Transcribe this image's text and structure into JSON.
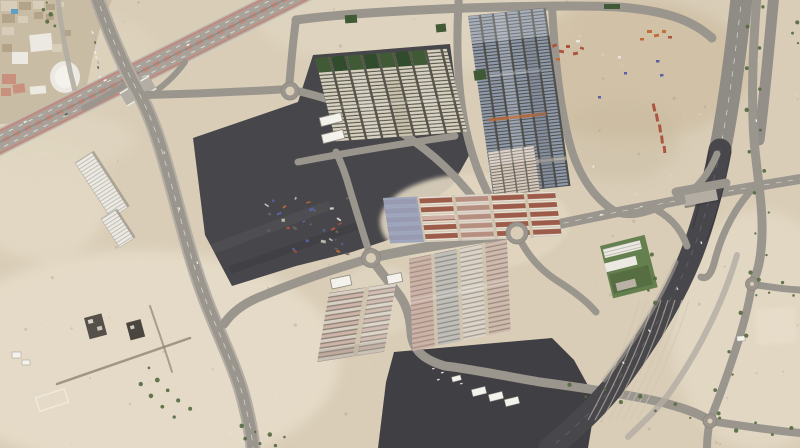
{
  "meta": {
    "type": "satellite-imagery",
    "description": "Aerial satellite view of a desert industrial district: container and trailer cabin yards, dark asphalt laydown lots, a striped divided highway with an overpass near an urban block, five roundabouts, a dark curving expressway and tree-lined service roads",
    "width": 800,
    "height": 448
  },
  "palette": {
    "sand": "#d9cdb7",
    "sand-light": "#e7ddca",
    "sand-mid": "#e0d5c0",
    "sand-dark": "#c6b69b",
    "dirt-brown": "#cdbc9f",
    "mottle-dark": "#a8937a",
    "mottle-light": "#ece4d2",
    "road": "#9a958d",
    "road-light": "#b3ada3",
    "road-dark": "#84807a",
    "lane-line": "#eeece6",
    "hw-base": "#a8a29a",
    "stripe-pink": "#c9877a",
    "median-grey": "#8b867e",
    "asphalt-lot": "#47464a",
    "asphalt-lot2": "#404044",
    "expressway-dark": "#48474b",
    "wall-dark": "#323237",
    "yard-tan": "#d7d0bf",
    "yard-tan-gap": "#56544b",
    "yard-blue": "#8f9aac",
    "yard-blue-gap": "#4e4e4a",
    "yard-red": "#9c5c49",
    "yard-white": "#e9e4da",
    "yard-lavender": "#97a1bb",
    "yard-pink": "#cdb3a8",
    "yard-pink2": "#d9cec3",
    "yard-row-gap": "#8a8275",
    "yard-mixed": "#d3c9bb",
    "aisle-sand": "#cfc4ae",
    "small-pink": "#d8c9bd",
    "small-pink-gap": "#6e6a60",
    "green-dark": "#3f5a35",
    "green-dark2": "#314c2c",
    "green-lawn": "#65804f",
    "tree-green": "#54693f",
    "tent-white": "#f4f2ec",
    "bld-white": "#ebe9e1",
    "bld-rib": "#82807a",
    "container-red": "#ad5540",
    "container-orange": "#bf6c38",
    "container-blue": "#5a62a5",
    "container-white": "#e8e4dc",
    "pool-blue": "#5f9fc4",
    "urban-base": "#c9bca4",
    "bld-tan": "#b3a489",
    "bld-tan2": "#d8cdb8",
    "bld-salmon": "#c9907e",
    "debris-light": "#e4ddcf",
    "shadow": "#6b675f"
  },
  "scene": {
    "roundabouts": [
      {
        "cx": 290,
        "cy": 91,
        "r": 9
      },
      {
        "cx": 371,
        "cy": 258,
        "r": 9.5
      },
      {
        "cx": 517,
        "cy": 233,
        "r": 11
      },
      {
        "cx": 752,
        "cy": 284,
        "r": 6.5
      },
      {
        "cx": 710,
        "cy": 421,
        "r": 7
      }
    ],
    "tents": [
      {
        "x": 320,
        "y": 115,
        "w": 22,
        "h": 9,
        "rot": -14
      },
      {
        "x": 322,
        "y": 132,
        "w": 22,
        "h": 9,
        "rot": -14
      },
      {
        "x": 331,
        "y": 277,
        "w": 20,
        "h": 10,
        "rot": -12
      },
      {
        "x": 387,
        "y": 274,
        "w": 15,
        "h": 9,
        "rot": -12
      }
    ],
    "trailers": [
      {
        "x": 472,
        "y": 388,
        "w": 14,
        "h": 7,
        "rot": -14
      },
      {
        "x": 489,
        "y": 393,
        "w": 14,
        "h": 7,
        "rot": -14
      },
      {
        "x": 505,
        "y": 398,
        "w": 14,
        "h": 7,
        "rot": -14
      },
      {
        "x": 452,
        "y": 376,
        "w": 9,
        "h": 5,
        "rot": -14
      },
      {
        "x": 737,
        "y": 336,
        "w": 8,
        "h": 5,
        "rot": -4
      },
      {
        "x": 12,
        "y": 352,
        "w": 9,
        "h": 6,
        "rot": 0
      },
      {
        "x": 22,
        "y": 360,
        "w": 8,
        "h": 5,
        "rot": 0
      }
    ],
    "green_squares": [
      {
        "x": 345,
        "y": 15,
        "w": 12,
        "h": 8,
        "rot": -4
      },
      {
        "x": 436,
        "y": 24,
        "w": 10,
        "h": 8,
        "rot": -6
      },
      {
        "x": 474,
        "y": 70,
        "w": 12,
        "h": 10,
        "rot": -8
      },
      {
        "x": 604,
        "y": 4,
        "w": 16,
        "h": 5,
        "rot": 0
      }
    ],
    "containers": [
      {
        "x": 552,
        "y": 44,
        "w": 5,
        "h": 3,
        "rot": -20,
        "c": "container-red"
      },
      {
        "x": 559,
        "y": 50,
        "w": 5,
        "h": 3,
        "rot": 10,
        "c": "container-red"
      },
      {
        "x": 566,
        "y": 45,
        "w": 4,
        "h": 3,
        "rot": 0,
        "c": "container-red"
      },
      {
        "x": 573,
        "y": 52,
        "w": 5,
        "h": 3,
        "rot": -12,
        "c": "container-red"
      },
      {
        "x": 556,
        "y": 58,
        "w": 4,
        "h": 2.5,
        "rot": 0,
        "c": "container-orange"
      },
      {
        "x": 580,
        "y": 47,
        "w": 4,
        "h": 2.5,
        "rot": 20,
        "c": "container-red"
      },
      {
        "x": 576,
        "y": 40,
        "w": 4,
        "h": 2.5,
        "rot": 0,
        "c": "container-white"
      },
      {
        "x": 647,
        "y": 30,
        "w": 5,
        "h": 3,
        "rot": 0,
        "c": "container-orange"
      },
      {
        "x": 654,
        "y": 34,
        "w": 5,
        "h": 3,
        "rot": -10,
        "c": "container-orange"
      },
      {
        "x": 662,
        "y": 30,
        "w": 4,
        "h": 3,
        "rot": 8,
        "c": "container-orange"
      },
      {
        "x": 668,
        "y": 36,
        "w": 4,
        "h": 2.5,
        "rot": 0,
        "c": "container-red"
      },
      {
        "x": 640,
        "y": 38,
        "w": 4,
        "h": 2.5,
        "rot": 0,
        "c": "container-orange"
      },
      {
        "x": 656,
        "y": 60,
        "w": 3.5,
        "h": 2.5,
        "rot": 0,
        "c": "container-blue"
      },
      {
        "x": 660,
        "y": 74,
        "w": 3.5,
        "h": 2.5,
        "rot": -8,
        "c": "container-blue"
      },
      {
        "x": 624,
        "y": 72,
        "w": 3,
        "h": 2.5,
        "rot": 0,
        "c": "container-blue"
      },
      {
        "x": 598,
        "y": 96,
        "w": 3,
        "h": 2.5,
        "rot": 0,
        "c": "container-blue"
      },
      {
        "x": 650,
        "y": 106,
        "w": 8,
        "h": 3,
        "rot": 78,
        "c": "container-red"
      },
      {
        "x": 653,
        "y": 116,
        "w": 8,
        "h": 3,
        "rot": 80,
        "c": "container-red"
      },
      {
        "x": 656,
        "y": 127,
        "w": 8,
        "h": 3,
        "rot": 82,
        "c": "container-red"
      },
      {
        "x": 658,
        "y": 138,
        "w": 8,
        "h": 3,
        "rot": 84,
        "c": "container-red"
      },
      {
        "x": 661,
        "y": 148,
        "w": 7,
        "h": 3,
        "rot": 84,
        "c": "container-red"
      },
      {
        "x": 618,
        "y": 56,
        "w": 3,
        "h": 2.5,
        "rot": 0,
        "c": "container-white"
      }
    ],
    "urban_buildings": [
      {
        "x": 1,
        "y": 1,
        "w": 16,
        "h": 10,
        "rot": 0,
        "c": "bld-tan2"
      },
      {
        "x": 19,
        "y": 2,
        "w": 12,
        "h": 8,
        "rot": 0,
        "c": "bld-tan"
      },
      {
        "x": 33,
        "y": 1,
        "w": 11,
        "h": 8,
        "rot": 0,
        "c": "bld-tan2"
      },
      {
        "x": 2,
        "y": 14,
        "w": 13,
        "h": 9,
        "rot": 0,
        "c": "bld-tan"
      },
      {
        "x": 18,
        "y": 16,
        "w": 10,
        "h": 7,
        "rot": 0,
        "c": "bld-tan2"
      },
      {
        "x": 34,
        "y": 12,
        "w": 9,
        "h": 7,
        "rot": 0,
        "c": "bld-tan"
      },
      {
        "x": 2,
        "y": 27,
        "w": 12,
        "h": 8,
        "rot": 0,
        "c": "bld-tan2"
      },
      {
        "x": 46,
        "y": 4,
        "w": 9,
        "h": 6,
        "rot": 0,
        "c": "bld-tan"
      },
      {
        "x": 56,
        "y": 2,
        "w": 8,
        "h": 5,
        "rot": 0,
        "c": "bld-tan2"
      },
      {
        "x": 46,
        "y": 14,
        "w": 8,
        "h": 6,
        "rot": 0,
        "c": "bld-tan"
      },
      {
        "x": 30,
        "y": 34,
        "w": 22,
        "h": 17,
        "rot": -6,
        "c": "bld-white"
      },
      {
        "x": 12,
        "y": 52,
        "w": 16,
        "h": 12,
        "rot": 0,
        "c": "bld-white"
      },
      {
        "x": 2,
        "y": 44,
        "w": 10,
        "h": 8,
        "rot": 0,
        "c": "bld-tan"
      },
      {
        "x": 2,
        "y": 74,
        "w": 14,
        "h": 10,
        "rot": 0,
        "c": "bld-salmon"
      },
      {
        "x": 13,
        "y": 84,
        "w": 12,
        "h": 9,
        "rot": -8,
        "c": "bld-salmon"
      },
      {
        "x": 1,
        "y": 88,
        "w": 10,
        "h": 8,
        "rot": 0,
        "c": "bld-salmon"
      },
      {
        "x": 30,
        "y": 86,
        "w": 16,
        "h": 8,
        "rot": -5,
        "c": "bld-white"
      },
      {
        "x": 52,
        "y": 44,
        "w": 10,
        "h": 8,
        "rot": 0,
        "c": "bld-tan2"
      },
      {
        "x": 62,
        "y": 30,
        "w": 9,
        "h": 6,
        "rot": 0,
        "c": "bld-tan"
      },
      {
        "x": 11,
        "y": 9,
        "w": 7,
        "h": 5,
        "rot": 0,
        "c": "pool-blue"
      }
    ],
    "tree_lines": [
      {
        "d": "M757,-4 C753,45 751,95 754,140 C757,175 763,205 762,235 C761,262 757,274 752,284",
        "count": 14,
        "offset": 6.5
      },
      {
        "d": "M752,284 C747,318 734,356 721,392 C715,408 712,415 710,421",
        "count": 7,
        "offset": 6
      },
      {
        "d": "M710,421 C736,425 768,430 800,433",
        "count": 5,
        "offset": 5
      },
      {
        "d": "M752,284 C768,287 784,289 800,290",
        "count": 4,
        "offset": 5
      },
      {
        "d": "M44,0 C46,10 49,20 52,30",
        "count": 5,
        "offset": 3
      },
      {
        "d": "M140,370 C155,390 170,405 188,418",
        "count": 9,
        "offset": 8
      },
      {
        "d": "M236,430 C255,438 275,442 295,444",
        "count": 8,
        "offset": 5
      },
      {
        "d": "M646,250 C652,270 654,290 650,308",
        "count": 5,
        "offset": 4
      },
      {
        "d": "M560,388 C600,394 650,402 700,416",
        "count": 8,
        "offset": 5
      },
      {
        "d": "M793,18 C795,28 796,38 795,48",
        "count": 3,
        "offset": 3
      }
    ],
    "vehicle_lines": [
      {
        "d": "M93,30 L103,95",
        "count": 13,
        "offset": 2
      }
    ],
    "road_dots": [
      {
        "x": 163,
        "y": 152,
        "rot": 70
      },
      {
        "x": 178,
        "y": 208,
        "rot": 72
      },
      {
        "x": 196,
        "y": 262,
        "rot": 68
      },
      {
        "x": 640,
        "y": 206,
        "rot": -10
      },
      {
        "x": 600,
        "y": 214,
        "rot": -10
      },
      {
        "x": 700,
        "y": 242,
        "rot": 75
      },
      {
        "x": 676,
        "y": 288,
        "rot": 62
      },
      {
        "x": 648,
        "y": 330,
        "rot": 55
      },
      {
        "x": 622,
        "y": 362,
        "rot": 50
      },
      {
        "x": 757,
        "y": 60,
        "rot": 85
      },
      {
        "x": 755,
        "y": 120,
        "rot": 85
      },
      {
        "x": 592,
        "y": 166,
        "rot": 70
      },
      {
        "x": 432,
        "y": 368,
        "rot": -12
      },
      {
        "x": 441,
        "y": 372,
        "rot": -12
      },
      {
        "x": 452,
        "y": 378,
        "rot": -12
      },
      {
        "x": 460,
        "y": 383,
        "rot": -12
      },
      {
        "x": 437,
        "y": 379,
        "rot": -12
      }
    ],
    "debris_region": {
      "x": 264,
      "y": 196,
      "w": 84,
      "h": 58,
      "count": 32
    },
    "speckle": {
      "count": 170
    },
    "track_lines": {
      "count": 8,
      "spacing": 7
    }
  }
}
